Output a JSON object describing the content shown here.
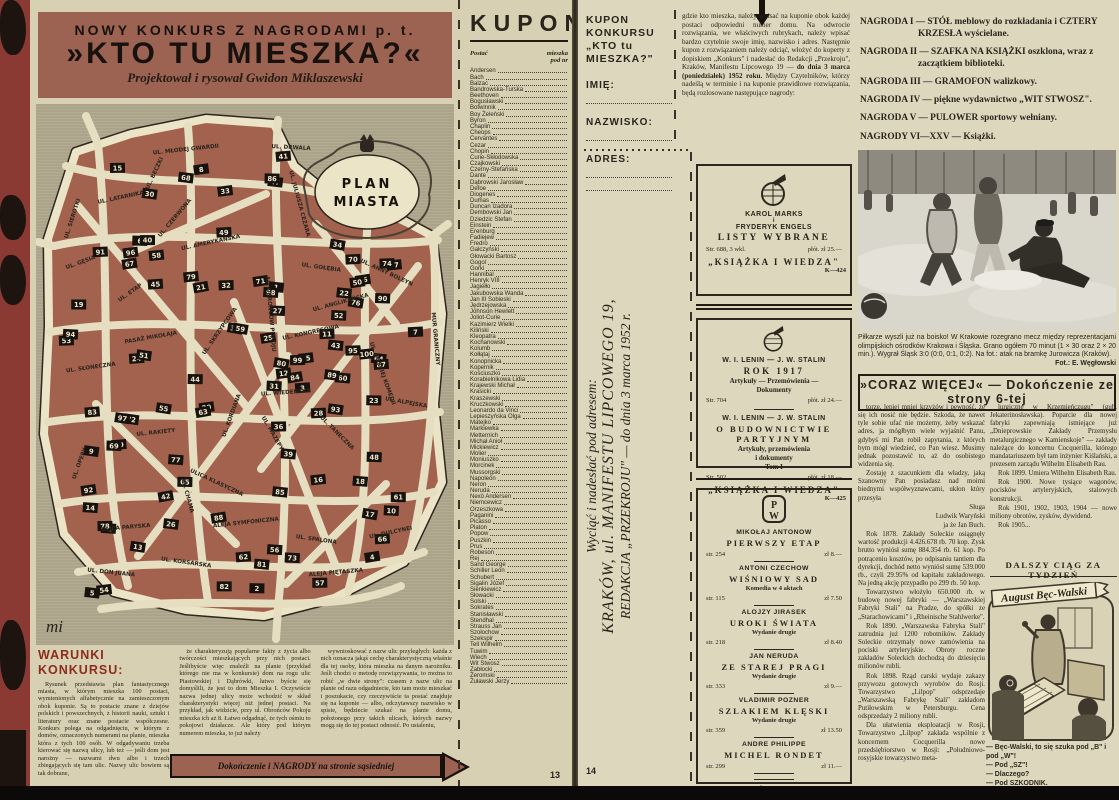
{
  "left_page": {
    "banner": {
      "line1": "NOWY KONKURS Z NAGRODAMI p. t.",
      "line2": "»KTO TU MIESZKA?«",
      "line3": "Projektował i rysował Gwidon Miklaszewski"
    },
    "map": {
      "cartouche_line1": "PLAN",
      "cartouche_line2": "MIASTA",
      "signature": "mi",
      "streets": [
        "UL. MŁODEJ GWARDII",
        "UL. DRWALA",
        "UL. SIEROTKI",
        "UL. LATARNIKA",
        "UL. BECZKI",
        "UL. JULIUSZA CEZARA",
        "UL. GĘSIA",
        "UL. CZERWONA",
        "UL. AMERYKAŃSKA",
        "UL. ANNY BOLEYN",
        "UL. ETAP",
        "AL. OBROŃCÓW POKOJU",
        "UL. GOŁĘBIA",
        "MUR GRANICZNY",
        "PASAŻ MIKOŁAJA",
        "UL. SKRZYPCOWA",
        "UL. KONGRESOWA",
        "UL. ANGLIKAŃSKA",
        "UL. SŁONECZNA",
        "UL. WIEDEŃSKA",
        "UL. BOSKIEJ KOMEDII",
        "UL. RAKIETY",
        "UL. KORDIANA",
        "UL. MAZEPY",
        "UL. TANECZNA",
        "UL. ALPEJSKA",
        "ULICA PARYSKA",
        "ALEJA SYMFONICZNA",
        "UL. SPALONA",
        "UL. DON JUANA",
        "UL. KORSARSKA",
        "ALEJA PIĘTASZKA",
        "UL. DULCYNEI",
        "ULICA KLASYCZNA",
        "UL. OPERY",
        "UL. CHAMA"
      ],
      "house_numbers": [
        1,
        2,
        3,
        4,
        5,
        6,
        7,
        8,
        9,
        10,
        11,
        12,
        13,
        14,
        15,
        16,
        17,
        18,
        19,
        20,
        21,
        22,
        23,
        24,
        25,
        26,
        27,
        28,
        29,
        30,
        31,
        32,
        33,
        34,
        35,
        36,
        37,
        38,
        39,
        40,
        41,
        42,
        43,
        44,
        45,
        46,
        47,
        48,
        49,
        50,
        51,
        52,
        53,
        54,
        55,
        56,
        57,
        58,
        59,
        60,
        61,
        62,
        63,
        64,
        65,
        66,
        67,
        68,
        69,
        70,
        71,
        72,
        73,
        74,
        75,
        76,
        77,
        78,
        79,
        80,
        81,
        82,
        83,
        84,
        85,
        86,
        87,
        88,
        89,
        90,
        91,
        92,
        93,
        94,
        95,
        96,
        97,
        98,
        99,
        100
      ]
    },
    "warunki": {
      "heading": "WARUNKI KONKURSU:",
      "col1": "Rysunek przedstawia plan fantastycznego miasta, w którym mieszka 100 postaci, wymienionych alfabetycznie na zamieszczonym obok kuponie. Są to postacie znane z dziejów polskich i powszechnych, z historii nauki, sztuki i literatury oraz znane postacie współczesne. Konkurs polega na odgadnięciu, w którym z domów, oznaczonych numerami na planie, mieszka która z tych 100 osób. W odgadywaniu trzeba kierować się nazwą ulicy, lub też — jeśli dom jest narożny — nazwami dwu albo i trzech zbiegających się tam ulic. Nazwy ulic bowiem są tak dobrane,",
      "col2": "że charakteryzują popularne fakty z życia albo twórczości mieszkających przy nich postaci. Jeślibyście więc znaleźli na planie (przykład którego nie ma w konkursie) dom na rogu ulic Piastowskiej i Dąbrówki, łatwo byście się domyślili, że jest to dom Mieszka I. Oczywiście nazwa jednej ulicy może wchodzić w skład charakterystyki więcej niż jednej postaci. Na przykład, jak widzicie, przy ul. Obrońców Pokoju mieszka ich aż 8. Łatwo odgadnąć, że tych ośmiu to pokojowi działacze. Ale który pod którym numerem mieszka, to już należy",
      "col3": "wywnioskować z nazw ulic przyległych: każda z nich oznacza jakąś cechę charakterystyczną właśnie dla tej osoby, która mieszka na danym narożniku. Jeśli chodzi o metodę rozwiązywania, to można to robić „w dwie strony\": czasem z nazw ulic na planie od razu odgadniecie, kto tam może mieszkać i poszukacie, czy rzeczywiście ta postać znajduje się na kuponie — albo, odczytawszy nazwisko w spisie, będziecie szukać na planie domu, położonego przy takich ulicach, których nazwy mogą się do tej postaci odnosić. Po ustaleniu,",
      "arrow_label": "Dokończenie i NAGRODY na stronie sąsiedniej"
    },
    "kupon": {
      "title": "KUPON",
      "col_postac": "Postać",
      "col_nr_line1": "mieszka",
      "col_nr_line2": "pod nr",
      "names": [
        "Andersen",
        "Bach",
        "Balzac",
        "Bandrowska-Turska",
        "Beethoven",
        "Bogusławski",
        "Botwinnik",
        "Boy Żeleński",
        "Byron",
        "Chaplin",
        "Cheops",
        "Cervantes",
        "Cezar",
        "Chopin",
        "Curie-Skłodowska",
        "Czajkowski",
        "Czerny-Stefańska",
        "Dante",
        "Dąbrowski Jarosław",
        "Defoe",
        "Diogenes",
        "Dumas",
        "Duncan Izadora",
        "Dembowski Jan",
        "Dziedzic Stefan",
        "Einstein",
        "Erenburg",
        "Fadiejew",
        "Fredro",
        "Gałczyński",
        "Głowacki Bartosz",
        "Gogol",
        "Gorki",
        "Hannibal",
        "Henryk VIII",
        "Jagiełło",
        "Jakubowska Wanda",
        "Jan III Sobieski",
        "Jędrzejowska",
        "Johnson Hewlett",
        "Joliot-Curie",
        "Kazimierz Wielki",
        "Kiliński",
        "Kleopatra",
        "Kochanowski",
        "Kolumb",
        "Kołłątaj",
        "Konopnicka",
        "Kopernik",
        "Kościuszko",
        "Korabielnikowa Lidia",
        "Krajewski Michał",
        "Krasicki",
        "Kraszewski",
        "Kruczkowski",
        "Leonardo da Vinci",
        "Lepieszyńska Olga",
        "Matejko",
        "Markiewka",
        "Metternich",
        "Michał Anioł",
        "Mickiewicz",
        "Molier",
        "Moniuszko",
        "Morcinek",
        "Mussorgski",
        "Napoleon",
        "Neron",
        "Neruda",
        "Nexö Andersen",
        "Niemcewicz",
        "Orzeszkowa",
        "Paganini",
        "Picasso",
        "Platon",
        "Popow",
        "Puszkin",
        "Prus",
        "Robeson",
        "Rej",
        "Sand George",
        "Schiller Leon",
        "Schubert",
        "Sigalin Józef",
        "Sienkiewicz",
        "Słowacki",
        "Solski",
        "Sokrates",
        "Stanisławski",
        "Stendhal",
        "Strauss Jan",
        "Szołochow",
        "Szekspir",
        "Tell Wilhelm",
        "Tuwim",
        "Wiech",
        "Wit Stwosz",
        "Zabłocki",
        "Żeromski",
        "Żuławski Jerzy"
      ],
      "page_number": "13"
    }
  },
  "fold": {
    "line1": "Wyciąć i nadesłać pod adresem:",
    "line2": "KRAKÓW, ul. MANIFESTU LIPCOWEGO 19,",
    "line3": "REDAKCJA „PRZEKROJU\" — do dnia 3 marca 1952 r."
  },
  "right_page": {
    "kupon_form": {
      "title_line1": "KUPON KONKURSU",
      "title_line2": "„KTO tu MIESZKA?\"",
      "field1": "IMIĘ:",
      "field2": "NAZWISKO:",
      "field3": "ADRES:"
    },
    "instructions": {
      "pre": "gdzie kto mieszka, należy wpisać na kuponie obok każdej postaci odpowiedni numer domu. Na odwrocie rozwiązania, we właściwych rubrykach, należy wpisać bardzo czytelnie swoje imię, nazwisko i adres. Następnie kupon z rozwiązaniem należy odciąć, włożyć do koperty z dopiskiem „Konkurs\" i nadesłać do Redakcji „Przekroju\", Kraków, Manifestu Lipcowego 19 — ",
      "bold": "do dnia 3 marca (poniedziałek) 1952 roku.",
      "post": " Między Czytelników, którzy nadeślą w terminie i na kuponie prawidłowe rozwiązania, będą rozlosowane następujące nagrody:"
    },
    "prizes": [
      "NAGRODA I — STÓŁ meblowy do rozkładania i CZTERY KRZESŁA wyścielane.",
      "NAGRODA II — SZAFKA NA KSIĄŻKI oszklona, wraz z zaczątkiem biblioteki.",
      "NAGRODA III — GRAMOFON walizkowy.",
      "NAGRODA IV — piękne wydawnictwo „WIT STWOSZ\".",
      "NAGRODA V — PULOWER sportowy wełniany.",
      "NAGRODY VI—XXV — Książki."
    ],
    "ads": {
      "kiw1": {
        "author1": "KAROL MARKS",
        "conj": "i",
        "author2": "FRYDERYK ENGELS",
        "title": "LISTY WYBRANE",
        "meta_left": "Str. 688, 3 wkl.",
        "meta_right": "płót. zł 25.—",
        "publisher": "„KSIĄŻKA I WIEDZA\"",
        "code": "K—424"
      },
      "kiw2": {
        "part1_authors": "W. I. LENIN — J. W. STALIN",
        "part1_title": "ROK 1917",
        "part1_sub1": "Artykuły — Przemówienia —",
        "part1_sub2": "Dokumenty",
        "part1_meta_left": "Str. 704",
        "part1_meta_right": "płót. zł 24.—",
        "part2_authors": "W. I. LENIN — J. W. STALIN",
        "part2_title": "O BUDOWNICTWIE PARTYJNYM",
        "part2_sub1": "Artykuły, przemówienia",
        "part2_sub2": "i dokumenty",
        "part2_tom": "Tom I",
        "part2_meta_left": "Str. 502",
        "part2_meta_right": "płót. zł 18.—",
        "publisher": "„KSIĄŻKA I WIEDZA\"",
        "code": "K—425"
      },
      "piw": {
        "books": [
          {
            "author": "MIKOŁAJ ANTONOW",
            "title": "PIERWSZY ETAP",
            "note": "",
            "meta_left": "str. 254",
            "meta_right": "zł 8.—"
          },
          {
            "author": "ANTONI CZECHOW",
            "title": "WIŚNIOWY SAD",
            "note": "Komedia w 4 aktach",
            "meta_left": "str. 115",
            "meta_right": "zł 7.50"
          },
          {
            "author": "ALOJZY JIRASEK",
            "title": "UROKI ŚWIATA",
            "note": "Wydanie drugie",
            "meta_left": "str. 218",
            "meta_right": "zł 8.40"
          },
          {
            "author": "JAN NERUDA",
            "title": "ZE STAREJ PRAGI",
            "note": "Wydanie drugie",
            "meta_left": "str. 333",
            "meta_right": "zł 9.—"
          },
          {
            "author": "VLADIMIR POZNER",
            "title": "SZLAKIEM KLĘSKI",
            "note": "Wydanie drugie",
            "meta_left": "str. 359",
            "meta_right": "zł 13.50"
          },
          {
            "author": "ANDRE PHILIPPE",
            "title": "MICHEL RONDET",
            "note": "",
            "meta_left": "str. 299",
            "meta_right": "zł 11.—"
          }
        ],
        "publisher_line1": "PAŃSTWOWY",
        "publisher_line2": "INSTYTUT WYDAWNICZY",
        "code": "K—464"
      }
    },
    "photo_caption": {
      "text": "Piłkarze wyszli już na boisko! W Krakowie rozegrano mecz między reprezentacjami olimpijskich ośrodków Krakowa i Śląska. Grano ogółem 70 minut (1 × 30 oraz 2 × 20 min.). Wygrał Śląsk 3:0 (0:0, 0:1, 0:2). Na fot.: atak na bramkę Jurowicza (Kraków).",
      "credit": "Fot.: E. Węgłowski"
    },
    "article": {
      "header": "»CORAZ WIĘCEJ« — Dokończenie ze strony 6-tej",
      "col1": [
        {
          "t": "torze, lepiej mniej krzyżów i pewność, że się ich nosić nie będzie. Szkoda, że nawet tyle sobie ufać nie możemy, żeby wskazać adres, ja mógłbym wiele wyjaśnić Panu, gdybyś mi Pan robił zapytania, z których bym mógł wiedzieć, co Pan wiesz. Musimy jednak pozostawić to, aż do osobistego widzenia się."
        },
        {
          "t": "Zostaję z szacunkiem dla władzy, jaką Szanowny Pan posiadasz nad moimi biednymi współwyznawcami, ukłon który przesyła"
        },
        {
          "t": "Sługa",
          "align": "right"
        },
        {
          "t": "Ludwik Waryński",
          "align": "right"
        },
        {
          "t": "ja że Jan Buch.",
          "align": "right"
        },
        {
          "t": "Rok 1878. Zakłady Soleckie osiągnęły wartość produkcji 4.426.678 rb. 70 kop. Zysk brutto wyniósł sumę 884.354 rb. 61 kop. Po potrąceniu kosztów, po odpisaniu tantiem dla dyrekcji, dochód netto wyniósł sumę 539.000 rb., czyli 29.95% od kapitału zakładowego. Na jedną akcję przypadło po 299 rb. 50 kop."
        },
        {
          "t": "Towarzystwo włożyło 650.000 rb. w budowę nowej fabryki — „Warszawskiej Fabryki Stali\" na Pradze, do spółki ze „Starachowicami\" i „Rheinische Stahlwerke\"."
        },
        {
          "t": "Rok 1890. „Warszawska Fabryka Stali\" zatrudnia już 1200 robotników. Zakłady Soleckie otrzymały nowe zamówienia na pociski artyleryjskie. Obroty roczne zakładów Soleckich dochodzą do dziesięciu milionów rubli."
        },
        {
          "t": "Rok 1898. Rząd carski wydaje zakazy przywozu gotowych wyrobów do Rosji. Towarzystwo „Lilpop\" odsprzedaje „Warszawską Fabrykę Stali\" zakładom Putiłowskim w Petersburgu. Cena odsprzedaży 2 miliony rubli."
        },
        {
          "t": "Dla ułatwienia eksploatacji w Rosji, Towarzystwo „Lilpop\" zakłada wspólnie z koncernem Cocquerilla nowe przedsiębiorstwo w Rosji: „Południowo-rosyjskie towarzystwo meta-"
        }
      ],
      "col2": [
        {
          "t": "lurgiczne w Krzemieńczugu\" (gub. Jekaterinosławska). Poparcie dla nowej fabryki zapewniają istniejące już „Dnieprowskie Zakłady Przemysłu metalurgicznego w Kamienskoje\" — zakłady należące do koncernu Cocquerilla, którego mandatariuszem był tam inżynier Kiślański, a prezesem zarządu Wilhelm Elisabeth Rau."
        },
        {
          "t": "Rok 1899. Umiera Wilhelm Elisabeth Rau."
        },
        {
          "t": "Rok 1900. Nowe tysiące wagonów, pocisków artyleryjskich, stalowych konstrukcji."
        },
        {
          "t": "Rok 1901, 1902, 1903, 1904 — nowe miliony obrotów, zysków, dywidend."
        },
        {
          "t": "Rok 1905..."
        }
      ],
      "footer": "DALSZY CIĄG ZA TYDZIEŃ"
    },
    "cartoon": {
      "banner": "August Bęc-Walski",
      "caption": [
        "— Bęc-Walski, to się szuka pod „B\" i pod „W\"!",
        "— Pod „SZ\"!",
        "— Dlaczego?",
        "— Pod SZKODNIK."
      ]
    },
    "page_number": "14"
  }
}
